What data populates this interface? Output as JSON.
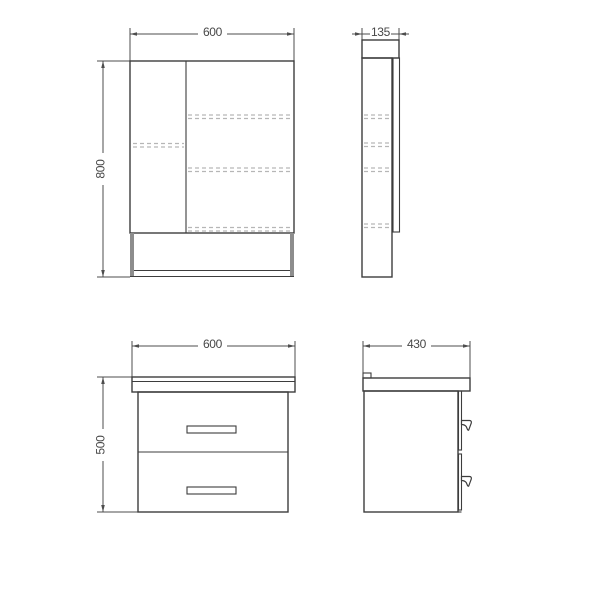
{
  "dimensions": {
    "mirror_front": {
      "width": "600",
      "height": "800"
    },
    "mirror_side": {
      "depth": "135"
    },
    "vanity_front": {
      "width": "600",
      "height": "500"
    },
    "vanity_side": {
      "depth": "430"
    }
  },
  "colors": {
    "outline": "#3d3d3d",
    "dimension_line": "#4d4d4d",
    "hidden_line": "#b6b6b6",
    "side_panel": "#8d8d8d",
    "background": "#ffffff"
  }
}
